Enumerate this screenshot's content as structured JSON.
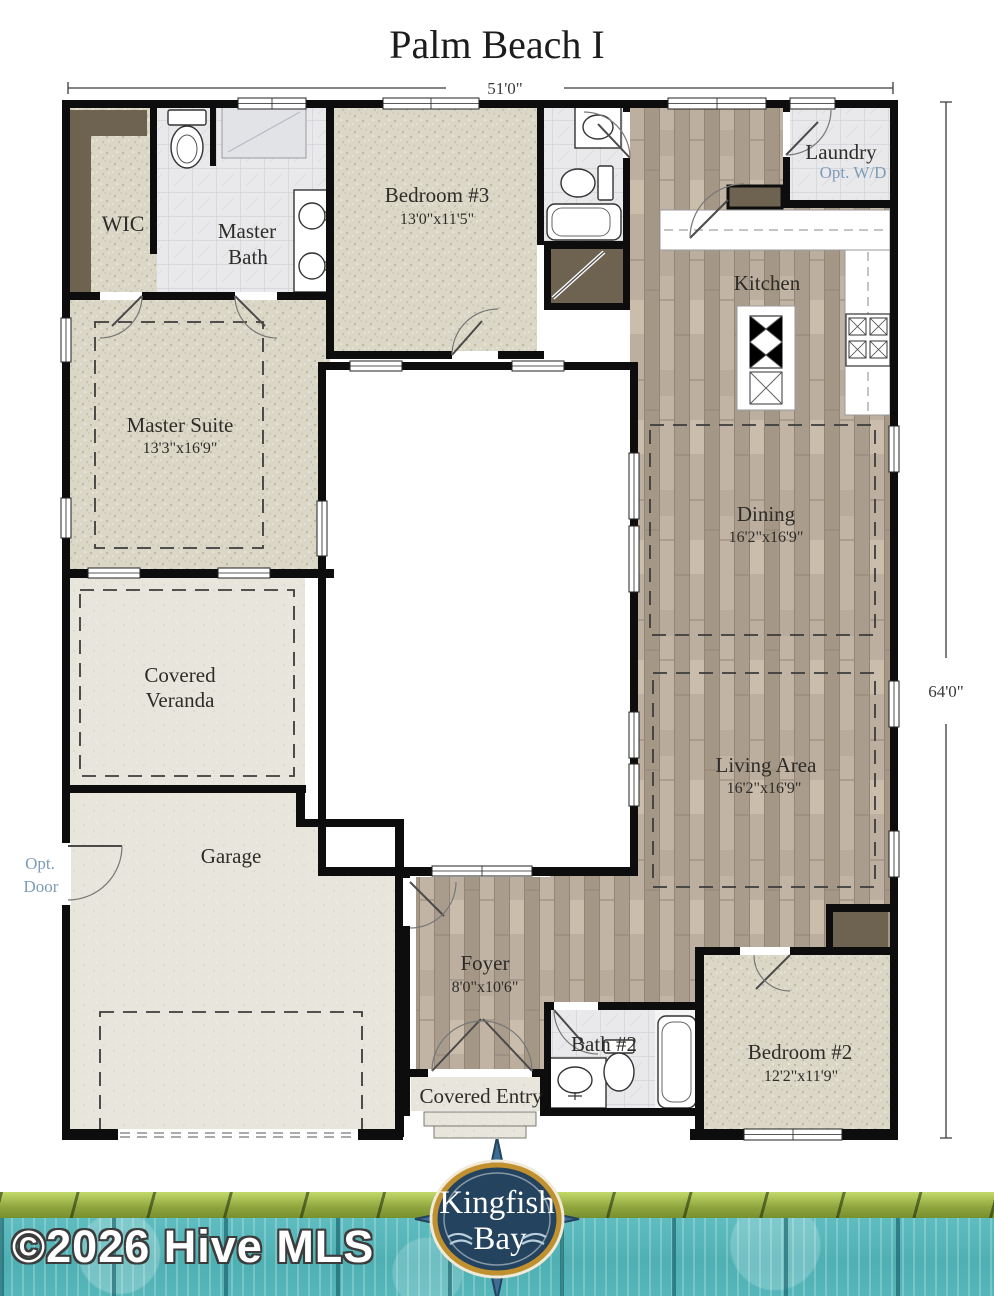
{
  "title": "Palm Beach I",
  "dimensions": {
    "width": "51'0\"",
    "height": "64'0\""
  },
  "rooms": {
    "wic": {
      "name": "WIC"
    },
    "master_bath": {
      "line1": "Master",
      "line2": "Bath"
    },
    "bedroom3": {
      "name": "Bedroom #3",
      "size": "13'0\"x11'5\""
    },
    "laundry": {
      "name": "Laundry",
      "option": "Opt. W/D"
    },
    "kitchen": {
      "name": "Kitchen"
    },
    "master_suite": {
      "name": "Master Suite",
      "size": "13'3\"x16'9\""
    },
    "dining": {
      "name": "Dining",
      "size": "16'2\"x16'9\""
    },
    "veranda": {
      "line1": "Covered",
      "line2": "Veranda"
    },
    "living": {
      "name": "Living Area",
      "size": "16'2\"x16'9\""
    },
    "garage": {
      "name": "Garage"
    },
    "opt_door": {
      "line1": "Opt.",
      "line2": "Door"
    },
    "foyer": {
      "name": "Foyer",
      "size": "8'0\"x10'6\""
    },
    "covered_entry": {
      "name": "Covered Entry"
    },
    "bath2": {
      "name": "Bath #2"
    },
    "bedroom2": {
      "name": "Bedroom #2",
      "size": "12'2\"x11'9\""
    }
  },
  "footer": {
    "copyright": "©2026 Hive MLS",
    "logo": {
      "line1": "Kingfish",
      "line2": "Bay"
    }
  },
  "colors": {
    "option_blue": "#7d9cb8",
    "wall_black": "#0d0d0d",
    "banner_teal": "#55b7ba",
    "banner_green": "#9ab23e",
    "logo_navy": "#24435e",
    "logo_gold": "#c2912f"
  }
}
